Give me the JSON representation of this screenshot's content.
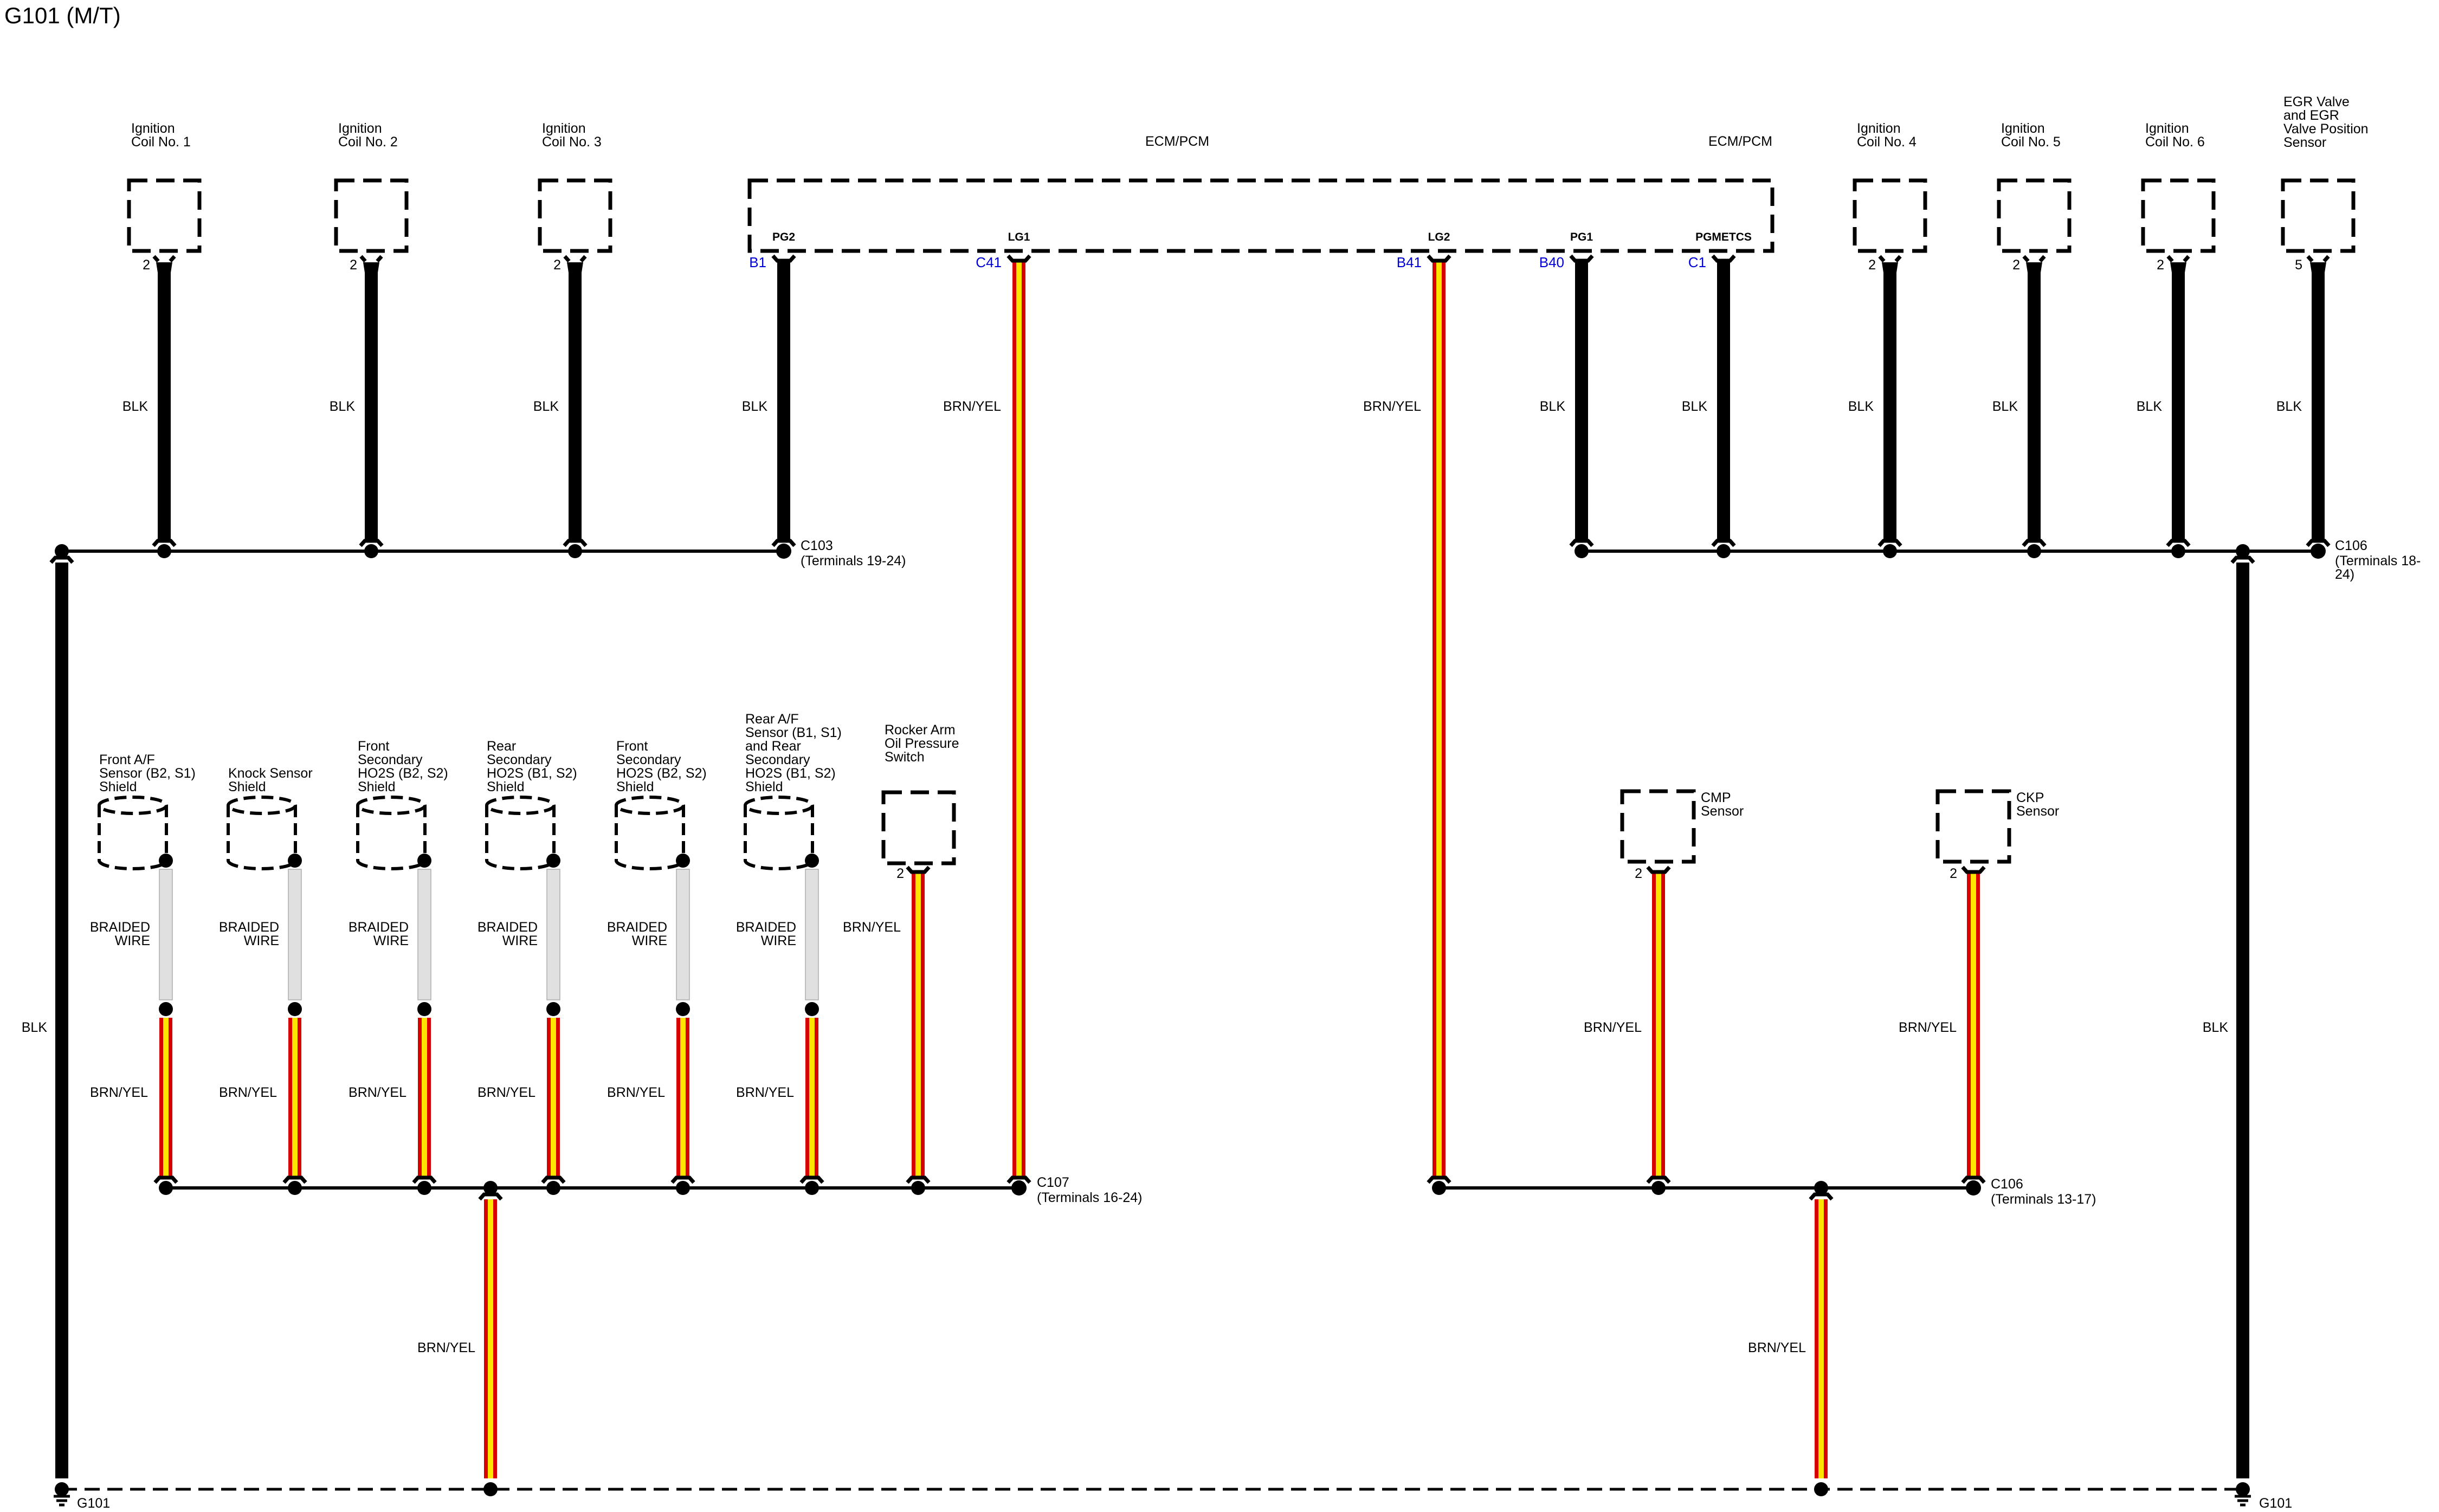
{
  "title": "G101 (M/T)",
  "blk": "BLK",
  "brnyel": "BRN/YEL",
  "braided_label": "BRAIDED\nWIRE",
  "ecm": {
    "label": "ECM/PCM",
    "label2": "ECM/PCM",
    "pins": [
      {
        "name": "PG2",
        "terminal": "B1"
      },
      {
        "name": "LG1",
        "terminal": "C41"
      },
      {
        "name": "LG2",
        "terminal": "B41"
      },
      {
        "name": "PG1",
        "terminal": "B40"
      },
      {
        "name": "PGMETCS",
        "terminal": "C1"
      }
    ]
  },
  "coils": [
    {
      "label": "Ignition\nCoil No. 1",
      "pin": "2"
    },
    {
      "label": "Ignition\nCoil No. 2",
      "pin": "2"
    },
    {
      "label": "Ignition\nCoil No. 3",
      "pin": "2"
    },
    {
      "label": "Ignition\nCoil No. 4",
      "pin": "2"
    },
    {
      "label": "Ignition\nCoil No. 5",
      "pin": "2"
    },
    {
      "label": "Ignition\nCoil No. 6",
      "pin": "2"
    }
  ],
  "egr": {
    "label": "EGR Valve\nand EGR\nValve Position\nSensor",
    "pin": "5"
  },
  "shields": [
    {
      "label": "Front A/F\nSensor (B2, S1)\nShield"
    },
    {
      "label": "Knock Sensor\nShield"
    },
    {
      "label": "Front\nSecondary\nHO2S (B2, S2)\nShield"
    },
    {
      "label": "Rear\nSecondary\nHO2S (B1, S2)\nShield"
    },
    {
      "label": "Front\nSecondary\nHO2S (B2, S2)\nShield"
    },
    {
      "label": "Rear A/F\nSensor (B1, S1)\nand Rear\nSecondary\nHO2S (B1, S2)\nShield"
    }
  ],
  "rocker": {
    "label": "Rocker Arm\nOil Pressure\nSwitch",
    "pin": "2"
  },
  "cmp": {
    "label": "CMP\nSensor",
    "pin": "2"
  },
  "ckp": {
    "label": "CKP\nSensor",
    "pin": "2"
  },
  "connectors": {
    "c103": {
      "name": "C103",
      "terminals": "(Terminals 19-24)"
    },
    "c106_top": {
      "name": "C106",
      "terminals": "(Terminals 18-24)"
    },
    "c107": {
      "name": "C107",
      "terminals": "(Terminals 16-24)"
    },
    "c106_bottom": {
      "name": "C106",
      "terminals": "(Terminals 13-17)"
    }
  },
  "grounds": {
    "left": "G101",
    "right": "G101"
  },
  "colors": {
    "blue": "#0000D6",
    "red": "#D60000",
    "yellow": "#FFE400",
    "braided": "#E0E0E0"
  }
}
